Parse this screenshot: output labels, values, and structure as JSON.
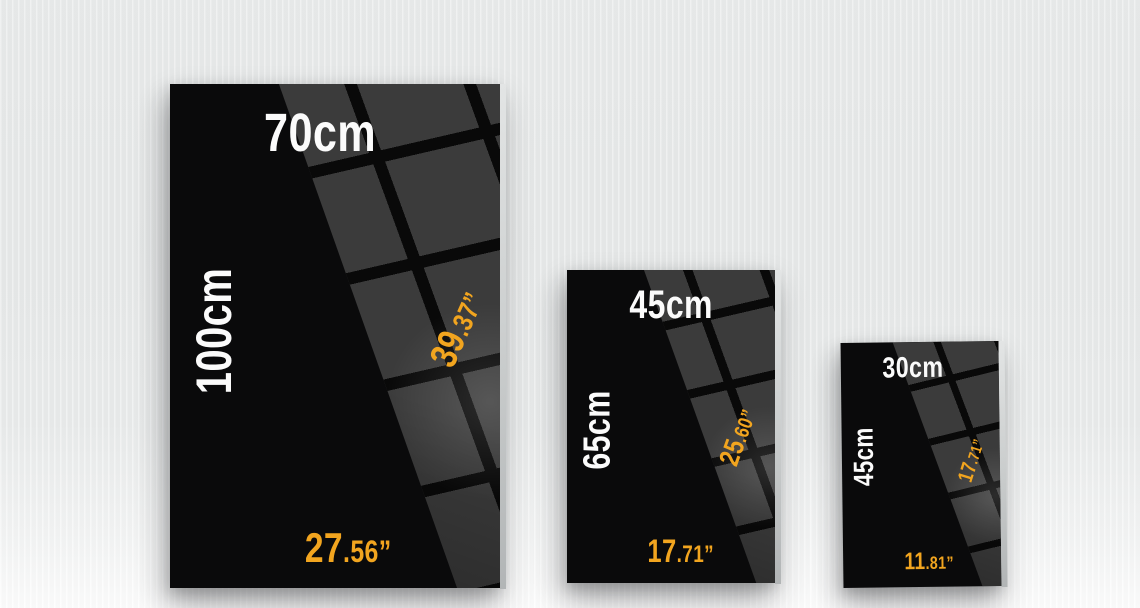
{
  "colors": {
    "accent_orange": "#F2A51F",
    "panel_black": "#0A0A0B",
    "tile_gray": "#3B3B3B",
    "background_gray": "#E8EAEA"
  },
  "panels": [
    {
      "id": "large",
      "width_cm": "70cm",
      "height_cm": "100cm",
      "height_inches": {
        "main": "39",
        "frac": ".37”"
      },
      "width_inches": {
        "main": "27",
        "frac": ".56”"
      }
    },
    {
      "id": "medium",
      "width_cm": "45cm",
      "height_cm": "65cm",
      "height_inches": {
        "main": "25",
        "frac": ".60”"
      },
      "width_inches": {
        "main": "17",
        "frac": ".71”"
      }
    },
    {
      "id": "small",
      "width_cm": "30cm",
      "height_cm": "45cm",
      "height_inches": {
        "main": "17",
        "frac": ".71”"
      },
      "width_inches": {
        "main": "11",
        "frac": ".81”"
      }
    }
  ]
}
